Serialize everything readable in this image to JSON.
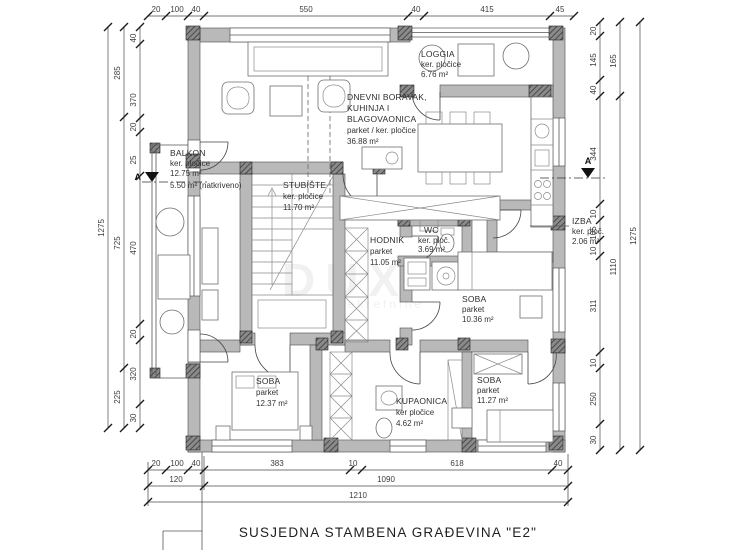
{
  "plan": {
    "rooms": {
      "living": {
        "line1": "DNEVNI BORAVAK,",
        "line2": "KUHINJA I",
        "line3": "BLAGOVAONICA",
        "finish": "parket / ker. pločice",
        "area": "36.88 m²"
      },
      "loggia": {
        "name": "LOGGIA",
        "finish": "ker. pločice",
        "area": "6.76 m²"
      },
      "balkon": {
        "name": "BALKON",
        "finish": "ker. pločice",
        "area": "12.75 m²",
        "area2": "5.50 m² (natkriveno)"
      },
      "stubiste": {
        "name": "STUBIŠTE",
        "finish": "ker. pločice",
        "area": "11.70 m²"
      },
      "hodnik": {
        "name": "HODNIK",
        "finish": "parket",
        "area": "11.05 m²"
      },
      "wc": {
        "name": "WC",
        "finish": "ker. ploč.",
        "area": "3.69 m²"
      },
      "izba": {
        "name": "IZBA",
        "finish": "ker. ploč.",
        "area": "2.06 m²"
      },
      "soba1": {
        "name": "SOBA",
        "finish": "parket",
        "area": "10.36 m²"
      },
      "soba2": {
        "name": "SOBA",
        "finish": "parket",
        "area": "12.37 m²"
      },
      "kupaonica": {
        "name": "KUPAONICA",
        "finish": "ker pločice",
        "area": "4.62 m²"
      },
      "soba3": {
        "name": "SOBA",
        "finish": "parket",
        "area": "11.27 m²"
      }
    },
    "dims": {
      "top": [
        "20",
        "100",
        "40",
        "550",
        "40",
        "415",
        "45"
      ],
      "bottom_row1": [
        "20",
        "100",
        "40",
        "383",
        "10",
        "618",
        "40"
      ],
      "bottom_row2": [
        "120",
        "1090"
      ],
      "bottom_row3": [
        "1210"
      ],
      "left_inner": [
        "40",
        "370",
        "20",
        "25",
        "470",
        "20",
        "320",
        "30"
      ],
      "left_middle": [
        "285",
        "725",
        "225"
      ],
      "left_outer": [
        "1275"
      ],
      "right_inner": [
        "20",
        "145",
        "40",
        "344",
        "10",
        "105",
        "10",
        "311",
        "10",
        "250",
        "30"
      ],
      "right_middle": [
        "165",
        "1110"
      ],
      "right_outer": [
        "1275"
      ]
    },
    "section_marker": "A",
    "footer": "SUSJEDNA STAMBENA GRAĐEVINA \"E2\"",
    "watermark": {
      "big": "DUX",
      "small": "nekretnine"
    },
    "colors": {
      "wall_fill": "#b9b9b9",
      "pier_dark": "#8a8a8a",
      "line": "#4a4a4a",
      "background": "#ffffff"
    }
  }
}
